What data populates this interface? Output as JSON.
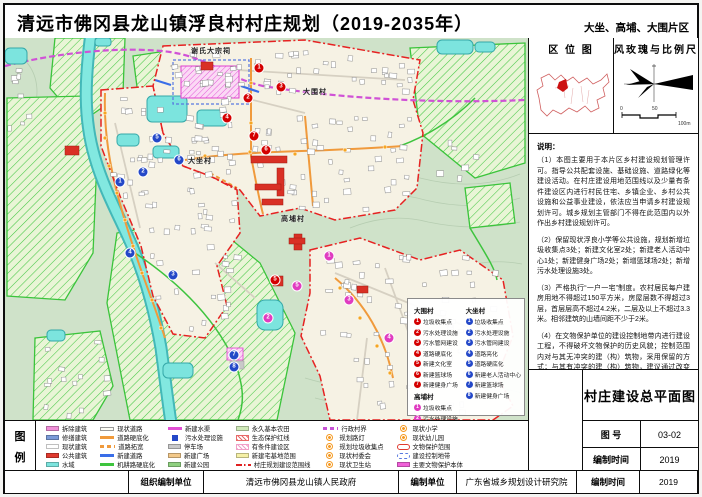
{
  "header": {
    "title": "清远市佛冈县龙山镇浮良村村庄规划（2019-2035年）",
    "area_label": "大坐、高埔、大围片区"
  },
  "sidebar": {
    "location_map_title": "区 位 图",
    "windrose_title": "风玫瑰与比例尺",
    "scale_labels": [
      "0",
      "50",
      "100m"
    ],
    "notes_heading": "说明：",
    "notes": [
      "（1）本图主要用于本片区乡村建设规划管理许可。指导公共配套设施、基础设施、道路绿化等建设活动。在村庄建设用地范围线以及少量有条件建设区内进行村民住宅、乡镇企业、乡村公共设施和公益事业建设，依法应当申请乡村建设规划许可。城乡规划主管部门不得在此范围内以外作出乡村建设规划许可。",
      "（2）保留现状浮良小学等公共设施，规划新增垃圾收集点3处；新建文化室2处；新建老人活动中心1处；新建健身广场2处；新增篮球场2处；新增污水处理设施3处。",
      "（3）严格执行“一户一宅”制度。农村居民每户建房用地不得超过150平方米，房屋层数不得超过3层，首层层高不超过4.2米，二层及以上不超过3.3米。相邻建筑的山墙间距不少于2米。",
      "（4）在文物保护单位的建设控制地带内进行建设工程，不得破坏文物保护的历史风貌；控制范围内对与其无冲突的建（构）筑物，采用保留的方式；与其有冲突的建（构）筑物，建议通过改变门面、体量和外观的方式取得和谐。"
    ]
  },
  "titleblock": {
    "drawing_name": "村庄建设总平面图",
    "sheet_no_label": "图 号",
    "sheet_no": "03-02",
    "date_label": "编制时间",
    "date": "2019"
  },
  "footer": {
    "org_label": "组织编制单位",
    "org_value": "清远市佛冈县龙山镇人民政府",
    "unit_label": "编制单位",
    "unit_value": "广东省城乡规划设计研究院",
    "time_label": "编制时间",
    "time_value": "2019"
  },
  "legend": {
    "title_chars": [
      "图",
      "例"
    ],
    "items": [
      {
        "label": "拆除建筑",
        "swatch": "rect",
        "color": "#f08fd8"
      },
      {
        "label": "修缮建筑",
        "swatch": "rect",
        "color": "#7b9bd8"
      },
      {
        "label": "现状建筑",
        "swatch": "rect",
        "color": "#ffffff"
      },
      {
        "label": "公共建筑",
        "swatch": "rect",
        "color": "#e03a2f"
      },
      {
        "label": "水域",
        "swatch": "rect",
        "color": "#7ce4de"
      },
      {
        "label": "现状道路",
        "swatch": "lineoutline",
        "color": "#fdfdf6"
      },
      {
        "label": "道路硬底化",
        "swatch": "line",
        "color": "#f09a3c"
      },
      {
        "label": "道路拓宽",
        "swatch": "dashline",
        "color": "#f09a3c"
      },
      {
        "label": "新建道路",
        "swatch": "line",
        "color": "#3a6ee8"
      },
      {
        "label": "机耕路硬底化",
        "swatch": "line",
        "color": "#3ec43e"
      },
      {
        "label": "新建水渠",
        "swatch": "line",
        "color": "#e24fd4"
      },
      {
        "label": "污水处理设施",
        "swatch": "square",
        "color": "#2448c8"
      },
      {
        "label": "停车场",
        "swatch": "rect",
        "color": "#c9c9c9"
      },
      {
        "label": "新建广场",
        "swatch": "rect",
        "color": "#f3c98a"
      },
      {
        "label": "新建公园",
        "swatch": "rect",
        "color": "#8fd080"
      },
      {
        "label": "永久基本农田",
        "swatch": "rect",
        "color": "#cfe9b8"
      },
      {
        "label": "生态保护红线",
        "swatch": "hatch",
        "color": "#e86a6a"
      },
      {
        "label": "有条件建设区",
        "swatch": "hatch",
        "color": "#f0a0c8"
      },
      {
        "label": "新建宅基地范围",
        "swatch": "rect",
        "color": "#f5f0a6"
      },
      {
        "label": "村庄规划建设范围线",
        "swatch": "dashdot",
        "color": "#e02020"
      },
      {
        "label": "行政村界",
        "swatch": "dashline",
        "color": "#c752d6"
      },
      {
        "label": "规划路灯",
        "swatch": "icon",
        "color": "#f59a23"
      },
      {
        "label": "规划垃圾收集点",
        "swatch": "icon",
        "color": "#f59a23"
      },
      {
        "label": "现状村委会",
        "swatch": "icon",
        "color": "#f59a23"
      },
      {
        "label": "现状卫生站",
        "swatch": "icon",
        "color": "#f59a23"
      },
      {
        "label": "现状小学",
        "swatch": "icon",
        "color": "#f59a23"
      },
      {
        "label": "现状幼儿园",
        "swatch": "icon",
        "color": "#f59a23"
      },
      {
        "label": "文物保护范围",
        "swatch": "outline",
        "color": "#e03a2f"
      },
      {
        "label": "建设控制地带",
        "swatch": "dashoutline",
        "color": "#5878e0"
      },
      {
        "label": "主要文物保护本体",
        "swatch": "rect",
        "color": "#f060d8"
      }
    ]
  },
  "map": {
    "labels": {
      "heritage": "谢氏大宗祠",
      "village_top": "大围村",
      "village_mid": "大坐村",
      "village_bottom": "高埔村"
    },
    "marker_colors": {
      "dw": "#d40000",
      "dz": "#2448c8",
      "gb": "#e03cc0"
    },
    "key_groups": [
      {
        "id": "dw",
        "name": "大围村",
        "items": [
          "垃圾收集点",
          "污水处理设施",
          "污水管网建设",
          "道路硬底化",
          "新建文化室",
          "新建篮球场",
          "新建健身广场"
        ]
      },
      {
        "id": "gb",
        "name": "高埔村",
        "items": [
          "垃圾收集点",
          "污水处理设施",
          "污水管网建设",
          "道路硬底化",
          "新建文化室"
        ]
      },
      {
        "id": "dz",
        "name": "大坐村",
        "items": [
          "垃圾收集点",
          "污水处理设施",
          "污水管网建设",
          "道路亮化",
          "道路硬底化",
          "新建老人活动中心",
          "新建篮球场",
          "新建健身广场"
        ]
      }
    ],
    "markers": [
      {
        "g": "dw",
        "n": "1",
        "x": 254,
        "y": 30
      },
      {
        "g": "dw",
        "n": "2",
        "x": 243,
        "y": 60
      },
      {
        "g": "dw",
        "n": "3",
        "x": 276,
        "y": 49
      },
      {
        "g": "dw",
        "n": "4",
        "x": 222,
        "y": 80
      },
      {
        "g": "dw",
        "n": "5",
        "x": 270,
        "y": 242
      },
      {
        "g": "dw",
        "n": "6",
        "x": 261,
        "y": 112
      },
      {
        "g": "dw",
        "n": "7",
        "x": 249,
        "y": 98
      },
      {
        "g": "dz",
        "n": "1",
        "x": 115,
        "y": 144
      },
      {
        "g": "dz",
        "n": "2",
        "x": 138,
        "y": 134
      },
      {
        "g": "dz",
        "n": "3",
        "x": 168,
        "y": 237
      },
      {
        "g": "dz",
        "n": "4",
        "x": 125,
        "y": 215
      },
      {
        "g": "dz",
        "n": "5",
        "x": 152,
        "y": 100
      },
      {
        "g": "dz",
        "n": "6",
        "x": 174,
        "y": 122
      },
      {
        "g": "dz",
        "n": "7",
        "x": 229,
        "y": 317
      },
      {
        "g": "dz",
        "n": "8",
        "x": 229,
        "y": 329
      },
      {
        "g": "gb",
        "n": "1",
        "x": 324,
        "y": 218
      },
      {
        "g": "gb",
        "n": "2",
        "x": 263,
        "y": 280
      },
      {
        "g": "gb",
        "n": "3",
        "x": 344,
        "y": 262
      },
      {
        "g": "gb",
        "n": "4",
        "x": 384,
        "y": 300
      },
      {
        "g": "gb",
        "n": "5",
        "x": 292,
        "y": 248
      }
    ]
  },
  "colors": {
    "boundary_red": "#e62222",
    "admin_purple": "#d052d6",
    "road_orange": "#f09a3c",
    "water_cyan": "#7ce4de",
    "farm_green": "#3bc43b",
    "lamp_orange": "#f5a623"
  }
}
